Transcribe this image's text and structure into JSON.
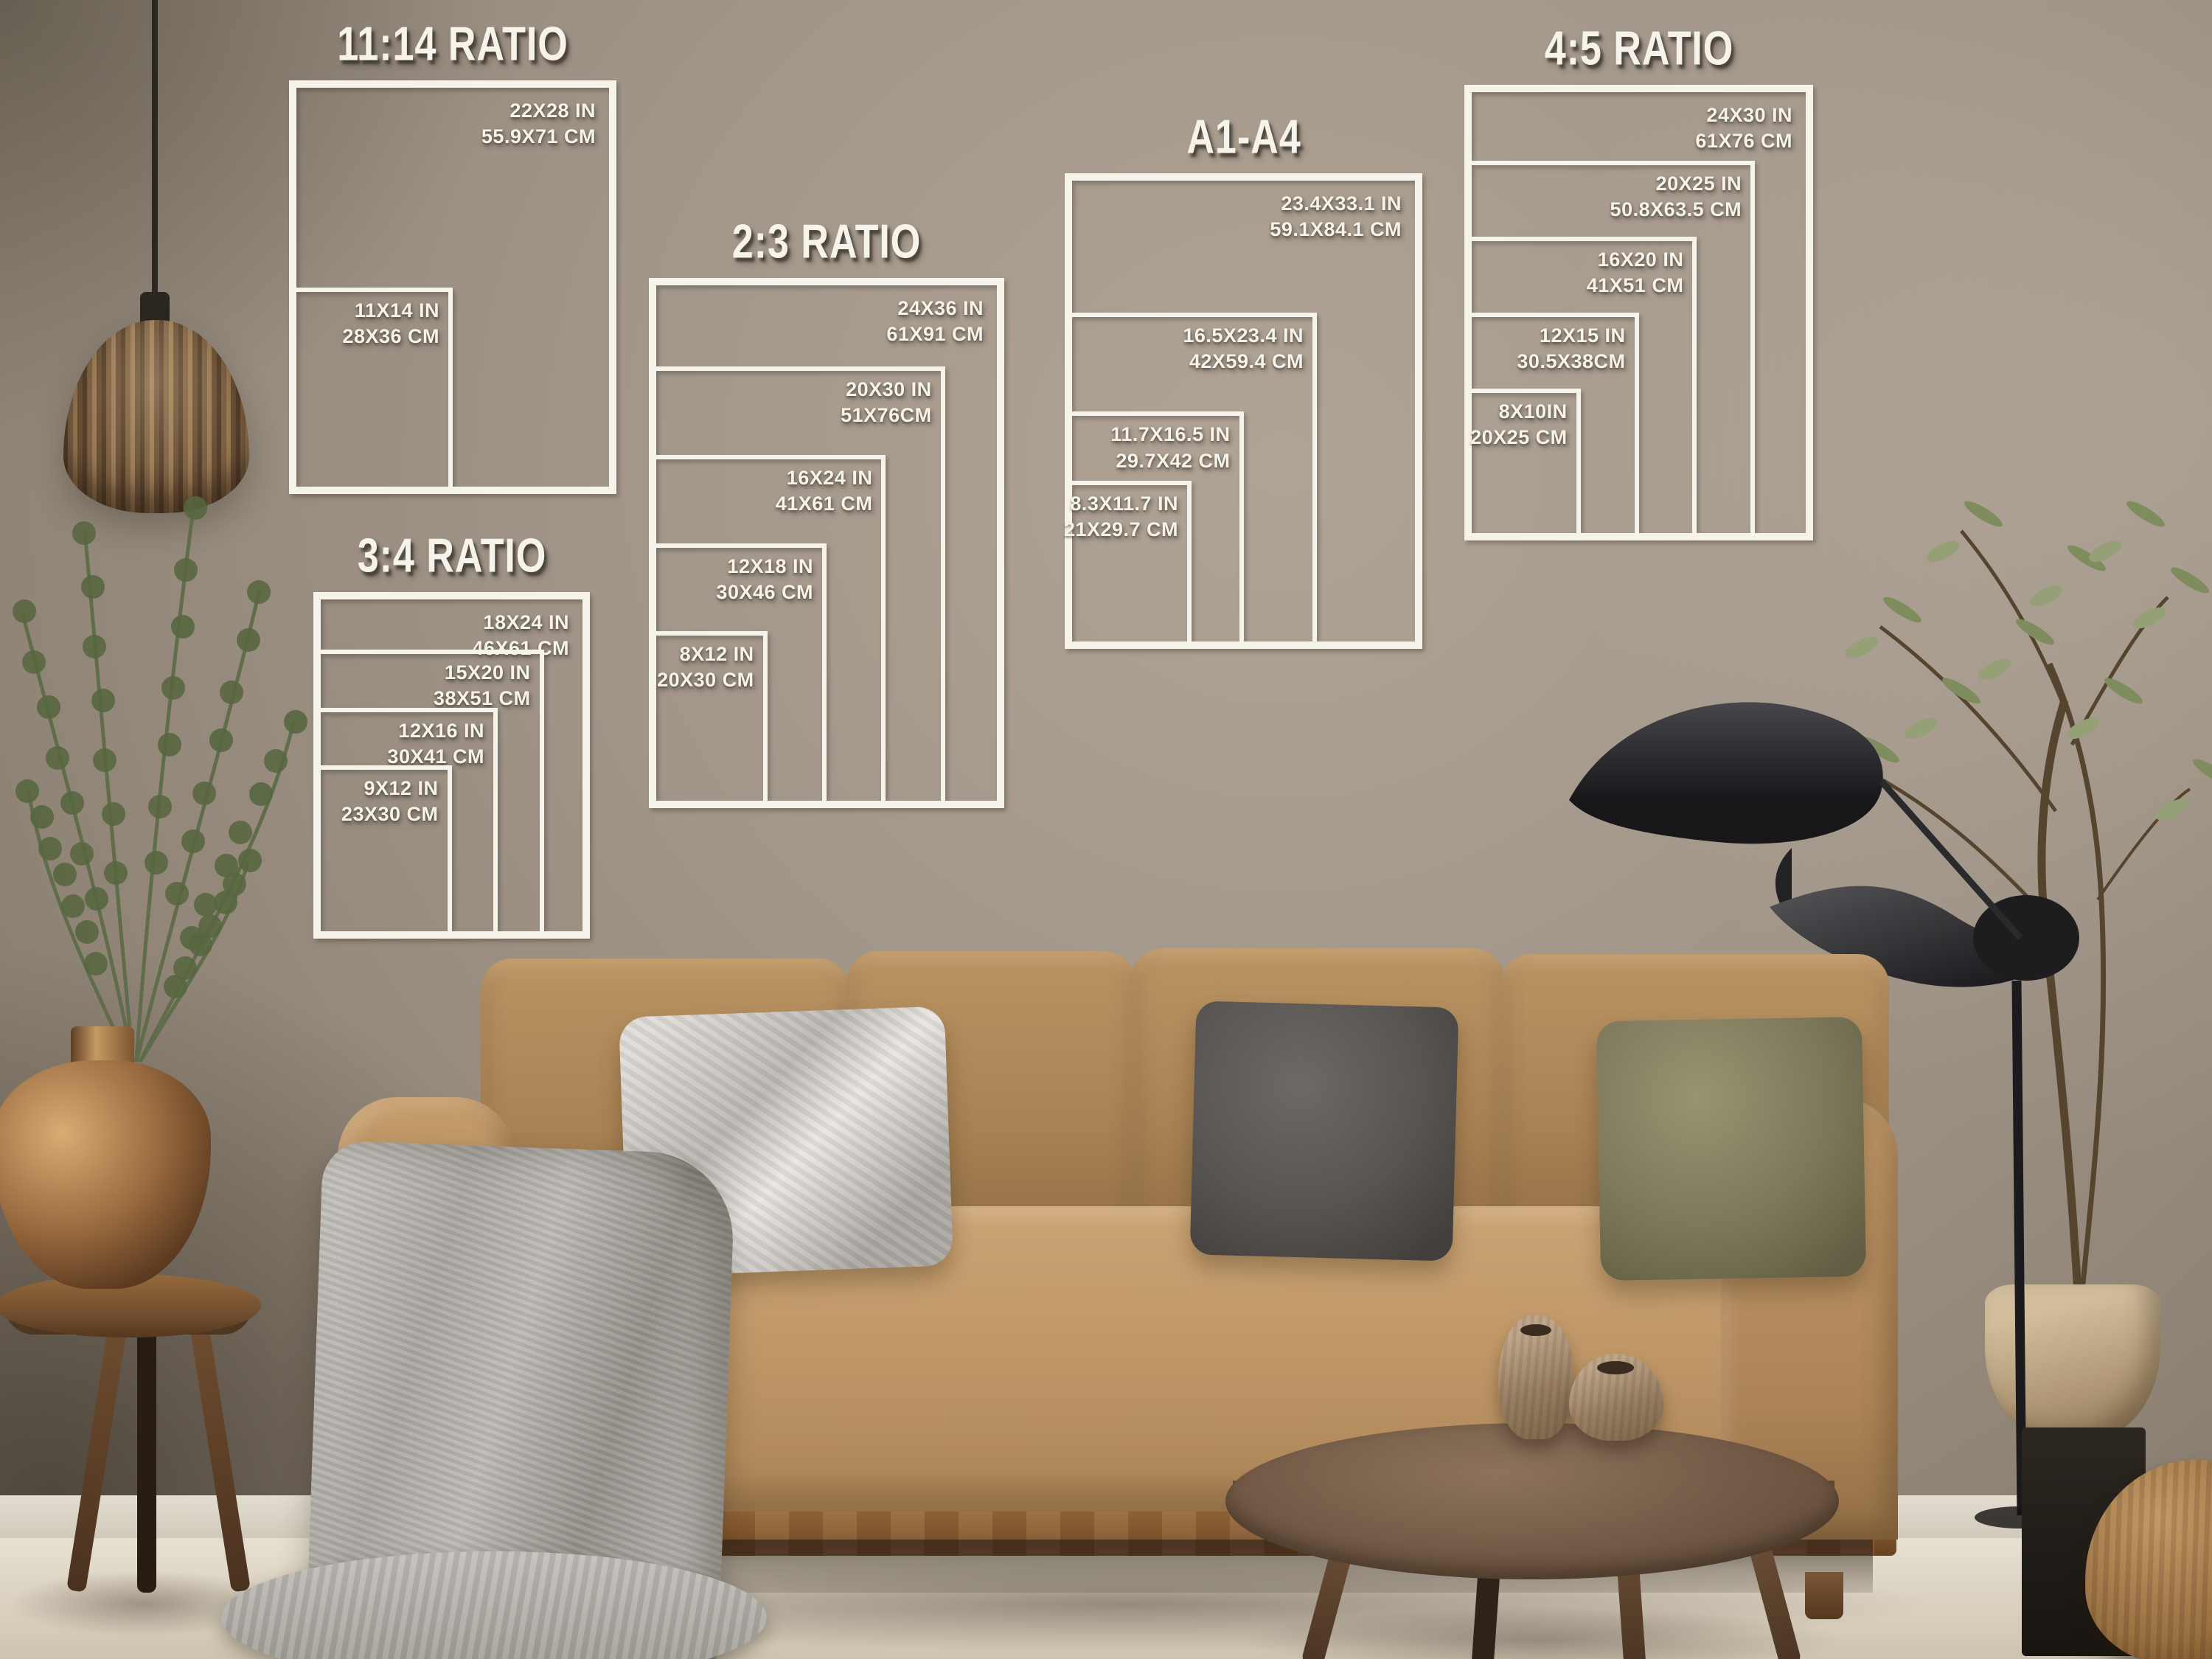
{
  "size_guides": [
    {
      "id": "ratio-11-14",
      "title": "11:14 RATIO",
      "sizes": [
        {
          "in": "22X28 IN",
          "cm": "55.9X71 CM",
          "w": 22,
          "h": 28
        },
        {
          "in": "11X14 IN",
          "cm": "28X36 CM",
          "w": 11,
          "h": 14
        }
      ]
    },
    {
      "id": "ratio-2-3",
      "title": "2:3 RATIO",
      "sizes": [
        {
          "in": "24X36 IN",
          "cm": "61X91 CM",
          "w": 24,
          "h": 36
        },
        {
          "in": "20X30 IN",
          "cm": "51X76CM",
          "w": 20,
          "h": 30
        },
        {
          "in": "16X24 IN",
          "cm": "41X61 CM",
          "w": 16,
          "h": 24
        },
        {
          "in": "12X18 IN",
          "cm": "30X46 CM",
          "w": 12,
          "h": 18
        },
        {
          "in": "8X12 IN",
          "cm": "20X30 CM",
          "w": 8,
          "h": 12
        }
      ]
    },
    {
      "id": "ratio-3-4",
      "title": "3:4 RATIO",
      "sizes": [
        {
          "in": "18X24 IN",
          "cm": "46X61 CM",
          "w": 18,
          "h": 24
        },
        {
          "in": "15X20 IN",
          "cm": "38X51 CM",
          "w": 15,
          "h": 20
        },
        {
          "in": "12X16 IN",
          "cm": "30X41 CM",
          "w": 12,
          "h": 16
        },
        {
          "in": "9X12 IN",
          "cm": "23X30 CM",
          "w": 9,
          "h": 12
        }
      ]
    },
    {
      "id": "a1-a4",
      "title": "A1-A4",
      "sizes": [
        {
          "in": "23.4X33.1 IN",
          "cm": "59.1X84.1 CM",
          "w": 23.4,
          "h": 33.1
        },
        {
          "in": "16.5X23.4 IN",
          "cm": "42X59.4 CM",
          "w": 16.5,
          "h": 23.4
        },
        {
          "in": "11.7X16.5 IN",
          "cm": "29.7X42 CM",
          "w": 11.7,
          "h": 16.5
        },
        {
          "in": "8.3X11.7 IN",
          "cm": "21X29.7 CM",
          "w": 8.3,
          "h": 11.7
        }
      ]
    },
    {
      "id": "ratio-4-5",
      "title": "4:5 RATIO",
      "sizes": [
        {
          "in": "24X30 IN",
          "cm": "61X76 CM",
          "w": 24,
          "h": 30
        },
        {
          "in": "20X25 IN",
          "cm": "50.8X63.5 CM",
          "w": 20,
          "h": 25
        },
        {
          "in": "16X20 IN",
          "cm": "41X51 CM",
          "w": 16,
          "h": 20
        },
        {
          "in": "12X15 IN",
          "cm": "30.5X38CM",
          "w": 12,
          "h": 15
        },
        {
          "in": "8X10IN",
          "cm": "20X25 CM",
          "w": 8,
          "h": 10
        }
      ]
    }
  ],
  "colors": {
    "overlay_white": "#f6f3ea",
    "wall": "#a2968a",
    "wall_shadow": "#6e6357",
    "floor": "#ddd5c6",
    "sofa": "#b68e5e",
    "sofa_seat": "#c6a072",
    "wood_rail": "#9a6c3d",
    "pillow_silver": "#cac6c1",
    "pillow_charcoal": "#5d5855",
    "pillow_olive": "#8a8668",
    "throw_blanket": "#b5b1ab",
    "pendant_rattan": "#7d6143",
    "copper_vase": "#9a6b3f",
    "table_wood": "#6b5340",
    "lamp_black": "#202023",
    "foliage": "#6e7d52"
  }
}
